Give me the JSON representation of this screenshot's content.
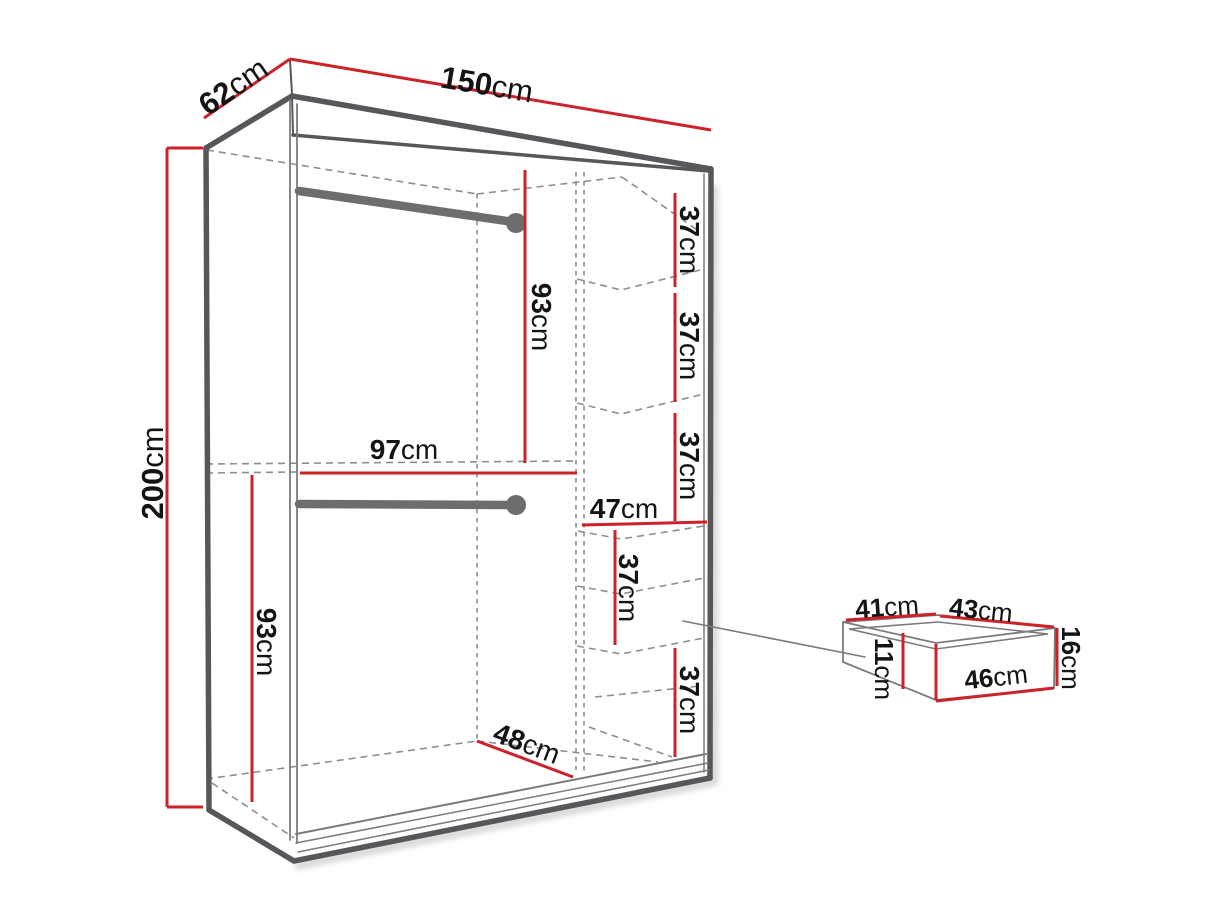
{
  "meta": {
    "description": "Wardrobe technical dimension diagram with shelf column and drawer detail",
    "unit": "cm"
  },
  "colors": {
    "dimension_red": "#cc2229",
    "edge_gray": "#57575b",
    "dash_gray": "#8e8e92",
    "rail_gray": "#6d6d70",
    "text": "#141414",
    "background": "#ffffff"
  },
  "labels": {
    "width": {
      "value": "150",
      "unit": "cm"
    },
    "depth": {
      "value": "62",
      "unit": "cm"
    },
    "height": {
      "value": "200",
      "unit": "cm"
    },
    "upper_section_height": {
      "value": "93",
      "unit": "cm"
    },
    "hanging_width": {
      "value": "97",
      "unit": "cm"
    },
    "lower_section_height": {
      "value": "93",
      "unit": "cm"
    },
    "shelf1_height": {
      "value": "37",
      "unit": "cm"
    },
    "shelf2_height": {
      "value": "37",
      "unit": "cm"
    },
    "shelf3_height": {
      "value": "37",
      "unit": "cm"
    },
    "column_width": {
      "value": "47",
      "unit": "cm"
    },
    "drawer_zone1_height": {
      "value": "37",
      "unit": "cm"
    },
    "drawer_zone2_height": {
      "value": "37",
      "unit": "cm"
    },
    "interior_depth": {
      "value": "48",
      "unit": "cm"
    },
    "drawer_inner_depth": {
      "value": "41",
      "unit": "cm"
    },
    "drawer_inner_width": {
      "value": "43",
      "unit": "cm"
    },
    "drawer_front_height": {
      "value": "16",
      "unit": "cm"
    },
    "drawer_front_width": {
      "value": "46",
      "unit": "cm"
    },
    "drawer_inner_height": {
      "value": "11",
      "unit": "cm"
    }
  }
}
